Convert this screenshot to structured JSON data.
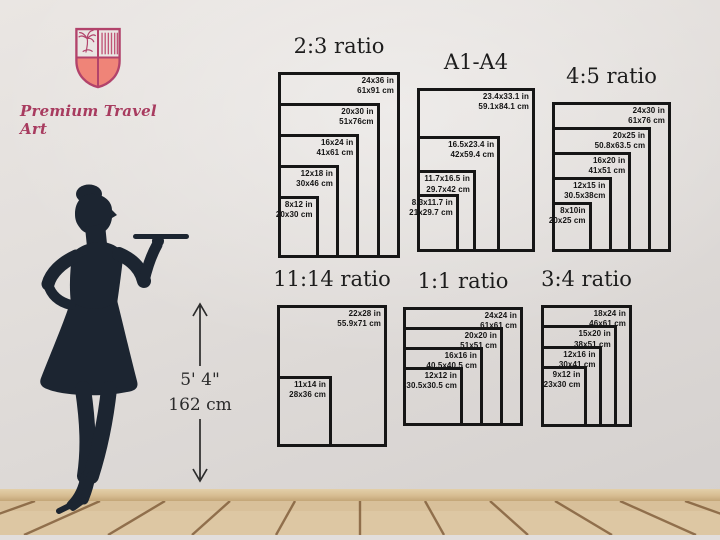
{
  "brand": {
    "name": "Premium Travel Art"
  },
  "height_marker": {
    "feet": "5' 4\"",
    "cm": "162 cm"
  },
  "colors": {
    "brand_pink": "#a83b5f",
    "shield_outline": "#b2436b",
    "shield_fill": "#ef8478",
    "silhouette": "#1c2531",
    "box_line": "#161616",
    "wall": "#e1ddda",
    "floor_wood": "#dcc6a2",
    "floor_line": "#7d5936"
  },
  "chart_data": {
    "type": "table",
    "note": "nested print-size diagrams",
    "groups": 6
  },
  "charts": [
    {
      "id": "2-3",
      "title": "2:3 ratio",
      "sizes": [
        {
          "w": 24,
          "h": 36,
          "inches": "24x36 in",
          "cm": "61x91 cm"
        },
        {
          "w": 20,
          "h": 30,
          "inches": "20x30 in",
          "cm": "51x76cm"
        },
        {
          "w": 16,
          "h": 24,
          "inches": "16x24 in",
          "cm": "41x61 cm"
        },
        {
          "w": 12,
          "h": 18,
          "inches": "12x18 in",
          "cm": "30x46 cm"
        },
        {
          "w": 8,
          "h": 12,
          "inches": "8x12 in",
          "cm": "20x30 cm"
        }
      ]
    },
    {
      "id": "a-series",
      "title": "A1-A4",
      "sizes": [
        {
          "w": 23.4,
          "h": 33.1,
          "inches": "23.4x33.1 in",
          "cm": "59.1x84.1 cm"
        },
        {
          "w": 16.5,
          "h": 23.4,
          "inches": "16.5x23.4 in",
          "cm": "42x59.4 cm"
        },
        {
          "w": 11.7,
          "h": 16.5,
          "inches": "11.7x16.5 in",
          "cm": "29.7x42 cm"
        },
        {
          "w": 8.3,
          "h": 11.7,
          "inches": "8.3x11.7 in",
          "cm": "21x29.7 cm"
        }
      ]
    },
    {
      "id": "4-5",
      "title": "4:5 ratio",
      "sizes": [
        {
          "w": 24,
          "h": 30,
          "inches": "24x30 in",
          "cm": "61x76 cm"
        },
        {
          "w": 20,
          "h": 25,
          "inches": "20x25 in",
          "cm": "50.8x63.5 cm"
        },
        {
          "w": 16,
          "h": 20,
          "inches": "16x20 in",
          "cm": "41x51 cm"
        },
        {
          "w": 12,
          "h": 15,
          "inches": "12x15 in",
          "cm": "30.5x38cm"
        },
        {
          "w": 8,
          "h": 10,
          "inches": "8x10in",
          "cm": "20x25 cm"
        }
      ]
    },
    {
      "id": "11-14",
      "title": "11:14 ratio",
      "sizes": [
        {
          "w": 22,
          "h": 28,
          "inches": "22x28 in",
          "cm": "55.9x71 cm"
        },
        {
          "w": 11,
          "h": 14,
          "inches": "11x14 in",
          "cm": "28x36 cm"
        }
      ]
    },
    {
      "id": "1-1",
      "title": "1:1 ratio",
      "sizes": [
        {
          "w": 24,
          "h": 24,
          "inches": "24x24 in",
          "cm": "61x61 cm"
        },
        {
          "w": 20,
          "h": 20,
          "inches": "20x20 in",
          "cm": "51x51 cm"
        },
        {
          "w": 16,
          "h": 16,
          "inches": "16x16 in",
          "cm": "40.5x40.5 cm"
        },
        {
          "w": 12,
          "h": 12,
          "inches": "12x12 in",
          "cm": "30.5x30.5 cm"
        }
      ]
    },
    {
      "id": "3-4",
      "title": "3:4 ratio",
      "sizes": [
        {
          "w": 18,
          "h": 24,
          "inches": "18x24 in",
          "cm": "46x61 cm"
        },
        {
          "w": 15,
          "h": 20,
          "inches": "15x20 in",
          "cm": "38x51 cm"
        },
        {
          "w": 12,
          "h": 16,
          "inches": "12x16 in",
          "cm": "30x41 cm"
        },
        {
          "w": 9,
          "h": 12,
          "inches": "9x12 in",
          "cm": "23x30 cm"
        }
      ]
    }
  ]
}
